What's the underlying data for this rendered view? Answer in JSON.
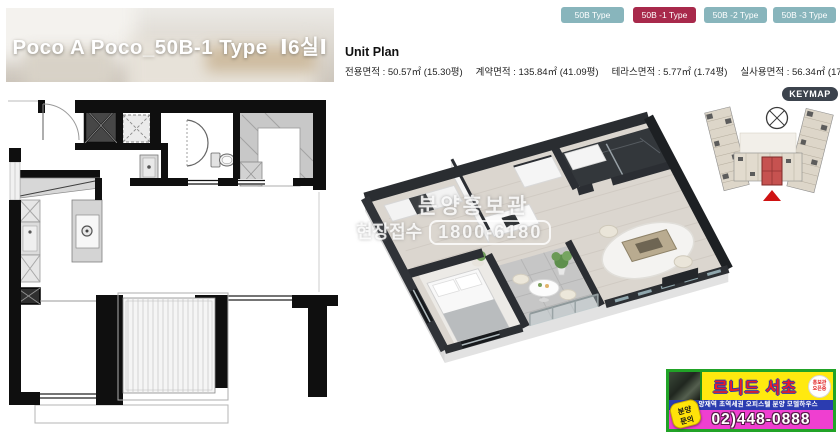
{
  "title_banner": {
    "text": "Poco A Poco_50B-1 Type  Ⅰ6실Ⅰ"
  },
  "tabs": [
    {
      "label": "50B Type",
      "active": false
    },
    {
      "label": "50B -1 Type",
      "active": true
    },
    {
      "label": "50B -2 Type",
      "active": false
    },
    {
      "label": "50B -3 Type",
      "active": false
    }
  ],
  "unit_plan": {
    "heading": "Unit Plan",
    "areas": [
      "전용면적 : 50.57㎡ (15.30평)",
      "계약면적 : 135.84㎡ (41.09평)",
      "테라스면적 : 5.77㎡ (1.74평)",
      "실사용면적 : 56.34㎡ (17.04평)"
    ]
  },
  "keymap": {
    "label": "KEYMAP",
    "icons": [
      "compass-icon",
      "location-marker-icon"
    ],
    "highlight_color": "#c65250"
  },
  "watermark": {
    "line1": "분양홍보관",
    "line2_prefix": "현장접수",
    "line2_number": "1800-6180"
  },
  "ad": {
    "title": "르니드 서초",
    "badge_line1": "홍보관",
    "badge_line2": "오픈중",
    "strip": "서초 양재역 초역세권 오피스텔 분양 모델하우스",
    "phone": "02)448-0888",
    "inquiry_line1": "분양",
    "inquiry_line2": "문의"
  },
  "colors": {
    "tab_default": "#88b5bc",
    "tab_active": "#a8294b",
    "keymap_badge": "#3c434d",
    "ad_border_green": "#21a327",
    "ad_yellow": "#ffe90f",
    "ad_blue": "#2b3cb0",
    "ad_pink": "#ef3fd0",
    "ad_red": "#ee1c25",
    "wall_dark": "#2a2d31"
  }
}
